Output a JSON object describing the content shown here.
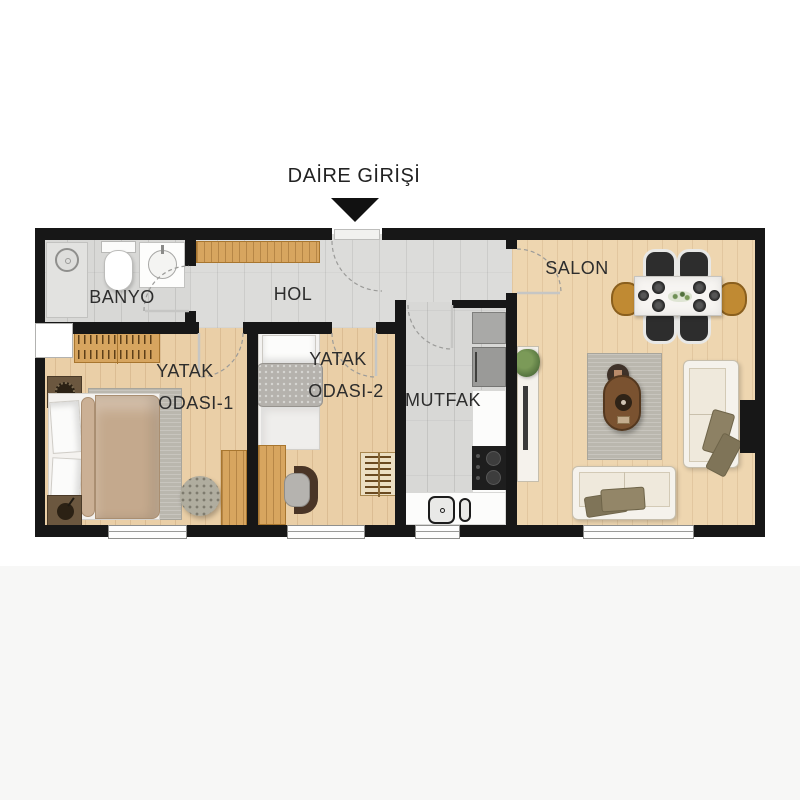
{
  "entrance": {
    "label": "DAİRE GİRİŞİ"
  },
  "rooms": {
    "banyo": {
      "label": "BANYO"
    },
    "hol": {
      "label": "HOL"
    },
    "salon": {
      "label": "SALON"
    },
    "mutfak": {
      "label": "MUTFAK"
    },
    "yatak_odasi_1": {
      "line1": "YATAK",
      "line2": "ODASI-1"
    },
    "yatak_odasi_2": {
      "line1": "YATAK",
      "line2": "ODASI-2"
    }
  },
  "palette": {
    "wall": "#171717",
    "tile_floor": "#d8d8d6",
    "wood_floor": "#eacfa7",
    "salon_floor": "#eed6b0",
    "cabinet_wood": "#d7a55f",
    "rug": "#bab7ae",
    "sofa_cream": "#f3eee3",
    "pillow_olive": "#8d8164",
    "chair_dark": "#2d2d2d",
    "chair_gold": "#c08a33",
    "text": "#2d2d2d"
  }
}
